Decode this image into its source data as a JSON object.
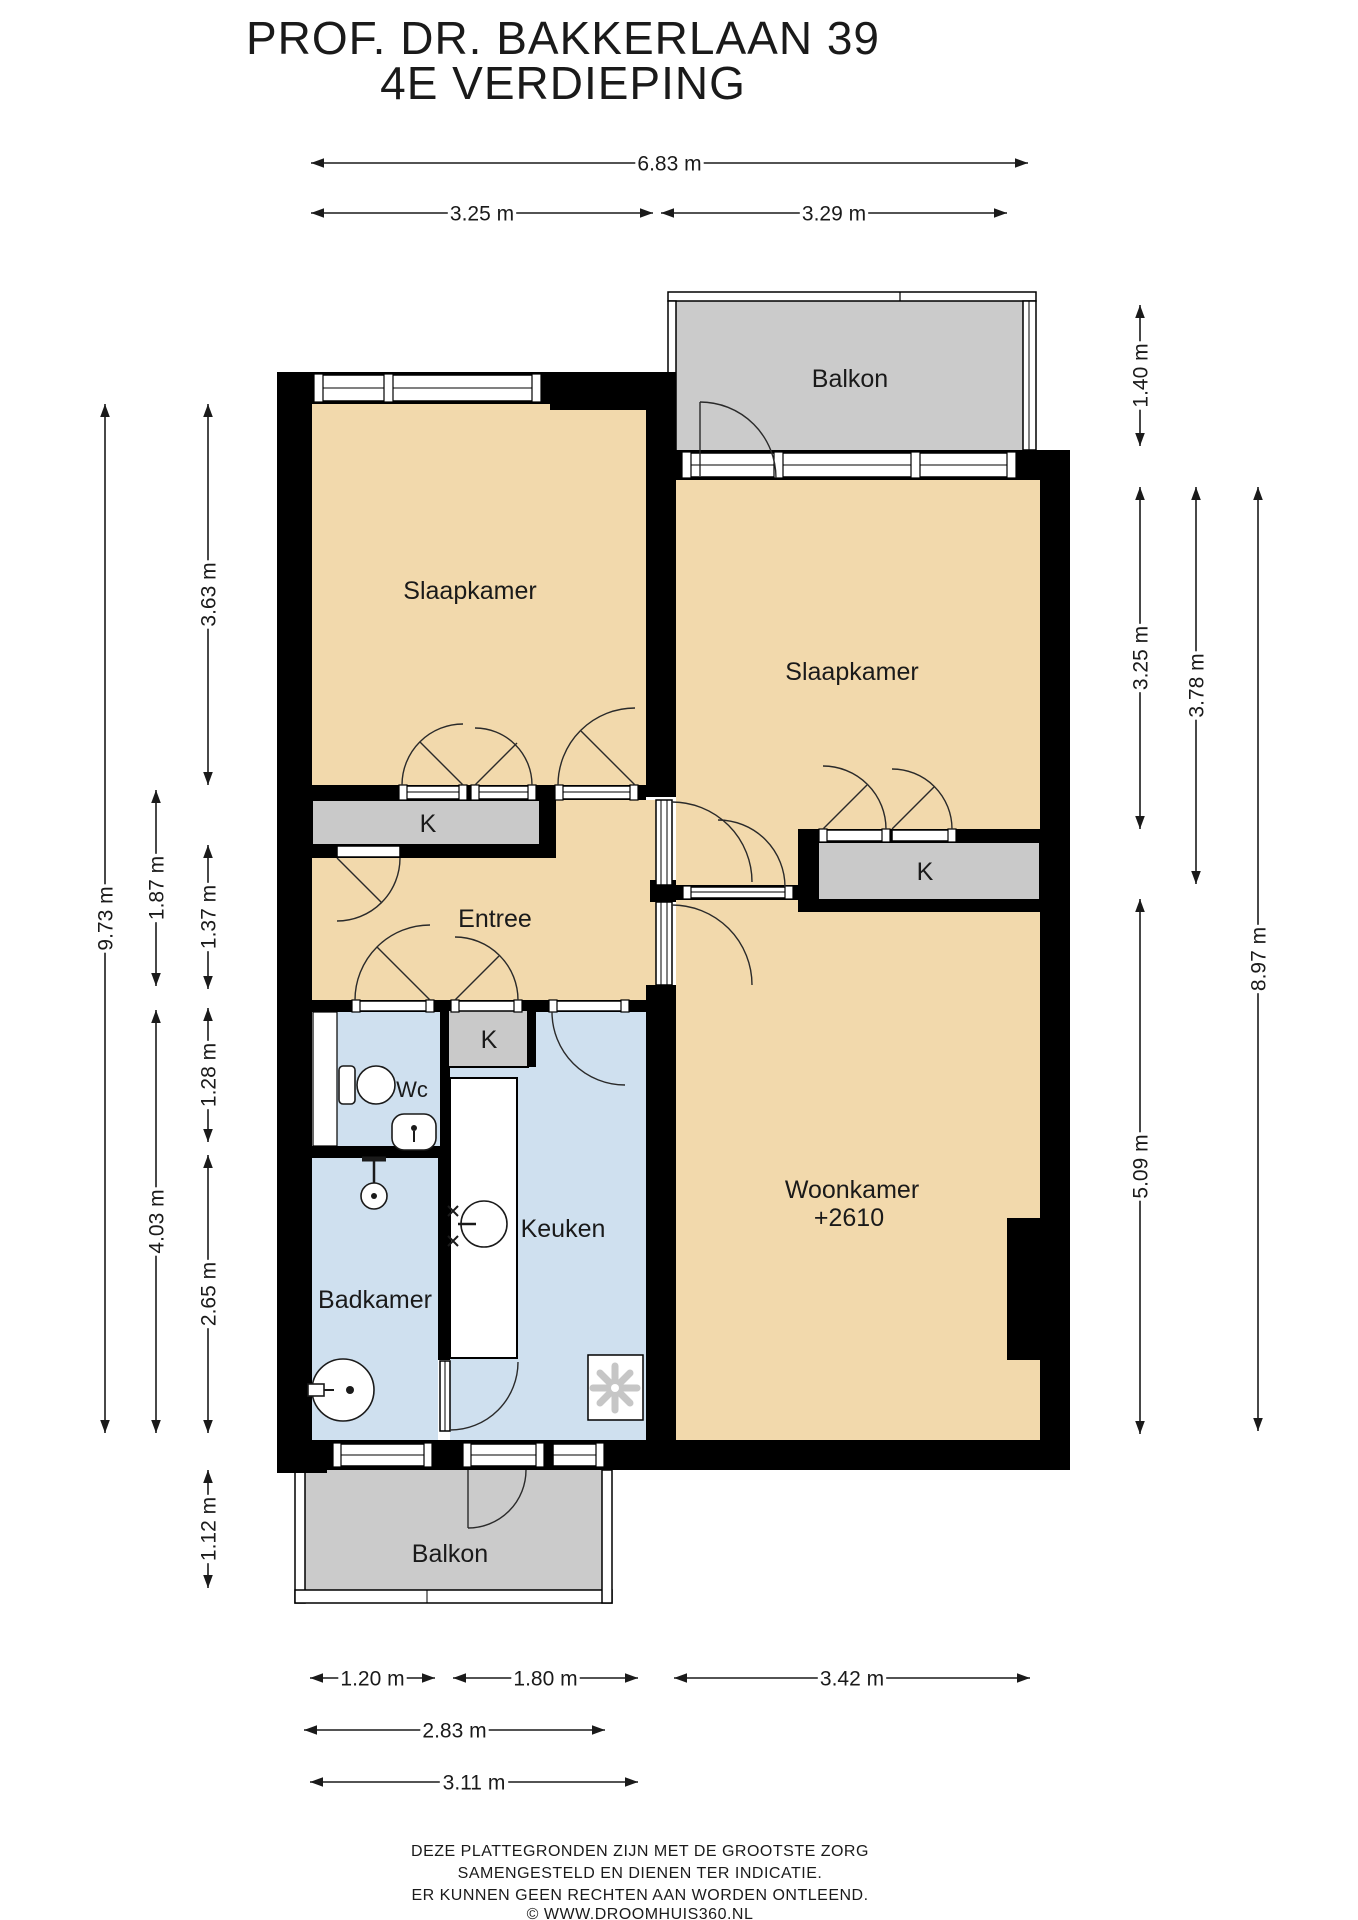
{
  "title": {
    "line1": "PROF. DR. BAKKERLAAN 39",
    "line2": "4E VERDIEPING"
  },
  "rooms": {
    "slaapkamer_left": "Slaapkamer",
    "slaapkamer_right": "Slaapkamer",
    "balkon_top": "Balkon",
    "balkon_bottom": "Balkon",
    "entree": "Entree",
    "wc": "Wc",
    "keuken": "Keuken",
    "badkamer": "Badkamer",
    "woonkamer": "Woonkamer",
    "woonkamer_ceiling_height": "+2610",
    "closet_left": "K",
    "closet_middle": "K",
    "closet_right": "K"
  },
  "dimensions": [
    {
      "label": "6.83 m",
      "dir": "h",
      "x1": 311,
      "x2": 1028,
      "y": 163
    },
    {
      "label": "3.25 m",
      "dir": "h",
      "x1": 311,
      "x2": 653,
      "y": 213
    },
    {
      "label": "3.29 m",
      "dir": "h",
      "x1": 661,
      "x2": 1007,
      "y": 213
    },
    {
      "label": "9.73 m",
      "dir": "v",
      "x": 105,
      "y1": 404,
      "y2": 1433
    },
    {
      "label": "3.63 m",
      "dir": "v",
      "x": 208,
      "y1": 404,
      "y2": 785
    },
    {
      "label": "1.87 m",
      "dir": "v",
      "x": 156,
      "y1": 790,
      "y2": 986
    },
    {
      "label": "1.37 m",
      "dir": "v",
      "x": 208,
      "y1": 845,
      "y2": 989
    },
    {
      "label": "1.28 m",
      "dir": "v",
      "x": 208,
      "y1": 1008,
      "y2": 1142
    },
    {
      "label": "4.03 m",
      "dir": "v",
      "x": 156,
      "y1": 1010,
      "y2": 1433
    },
    {
      "label": "2.65 m",
      "dir": "v",
      "x": 208,
      "y1": 1155,
      "y2": 1433
    },
    {
      "label": "1.12 m",
      "dir": "v",
      "x": 208,
      "y1": 1470,
      "y2": 1588
    },
    {
      "label": "1.40 m",
      "dir": "v",
      "x": 1140,
      "y1": 305,
      "y2": 446
    },
    {
      "label": "3.25 m",
      "dir": "v",
      "x": 1140,
      "y1": 487,
      "y2": 829
    },
    {
      "label": "3.78 m",
      "dir": "v",
      "x": 1196,
      "y1": 487,
      "y2": 884
    },
    {
      "label": "5.09 m",
      "dir": "v",
      "x": 1140,
      "y1": 899,
      "y2": 1434
    },
    {
      "label": "8.97 m",
      "dir": "v",
      "x": 1258,
      "y1": 487,
      "y2": 1431
    },
    {
      "label": "1.20 m",
      "dir": "h",
      "x1": 310,
      "x2": 435,
      "y": 1678
    },
    {
      "label": "1.80 m",
      "dir": "h",
      "x1": 453,
      "x2": 638,
      "y": 1678
    },
    {
      "label": "3.42 m",
      "dir": "h",
      "x1": 674,
      "x2": 1030,
      "y": 1678
    },
    {
      "label": "2.83 m",
      "dir": "h",
      "x1": 304,
      "x2": 605,
      "y": 1730
    },
    {
      "label": "3.11 m",
      "dir": "h",
      "x1": 310,
      "x2": 638,
      "y": 1782
    }
  ],
  "footer": {
    "line1": "DEZE PLATTEGRONDEN ZIJN MET DE GROOTSTE ZORG",
    "line2": "SAMENGESTELD EN DIENEN TER INDICATIE.",
    "line3": "ER KUNNEN GEEN RECHTEN AAN WORDEN ONTLEEND.",
    "line4": "© WWW.DROOMHUIS360.NL"
  },
  "colors": {
    "room": "#f2d9ac",
    "wet": "#cfe0ef",
    "balcony": "#cbcbcb",
    "closet": "#c9c9c9",
    "wall": "#000000",
    "text": "#1a1a1a"
  }
}
